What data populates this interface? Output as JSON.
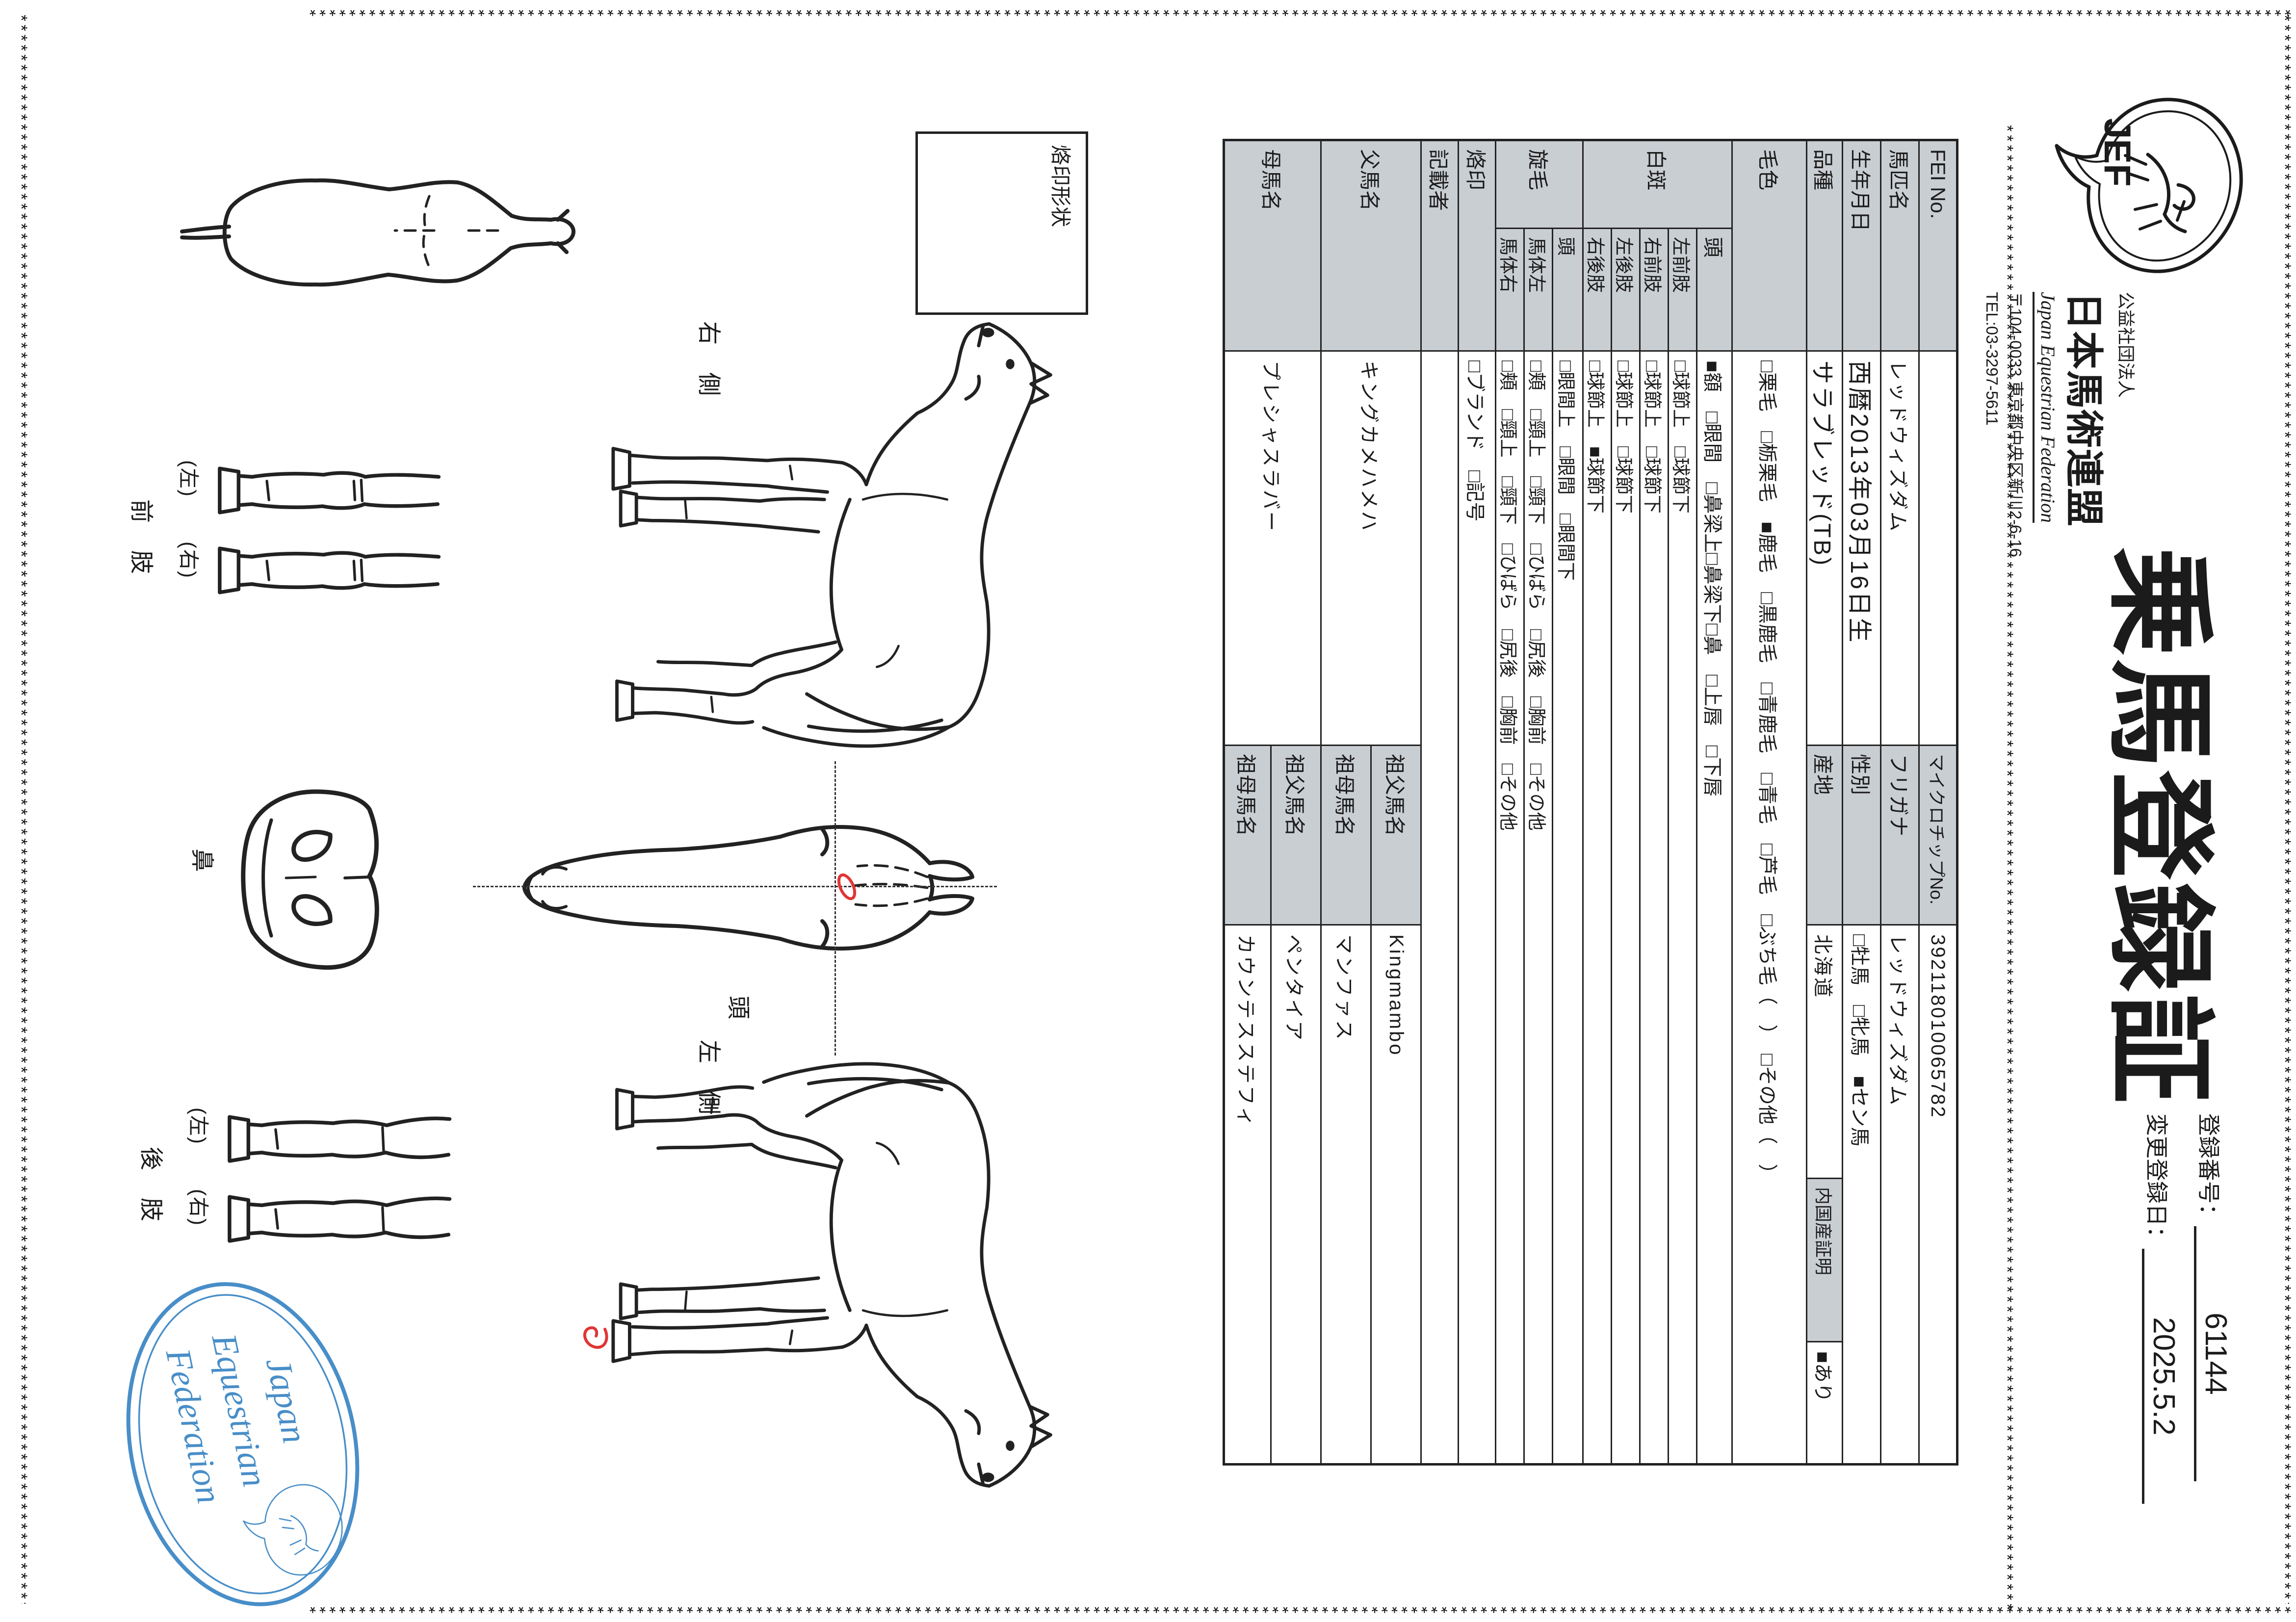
{
  "deco": {
    "line": "********************************************************************************************************************************************************************************************************"
  },
  "header": {
    "org_small": "公益社団法人",
    "org_name": "日本馬術連盟",
    "org_en": "Japan Equestrian Federation",
    "address": "〒104-0033 東京都中央区新川2-6-16",
    "tel": "TEL:03-3297-5611",
    "title": "乗馬登録証",
    "logo_text": "JEF"
  },
  "registration": {
    "no_label": "登録番号：",
    "no": "61144",
    "date_label": "変更登録日：",
    "date": "2025.5.2"
  },
  "table": {
    "fei": {
      "label": "FEI No.",
      "value": ""
    },
    "microchip": {
      "label": "マイクロチップNo.",
      "value": "392118010065782"
    },
    "name": {
      "label": "馬匹名",
      "value": "レッドウィズダム"
    },
    "kana": {
      "label": "フリガナ",
      "value": "レッドウィズダム"
    },
    "birth": {
      "label": "生年月日",
      "value": "西暦2013年03月16日生"
    },
    "sex": {
      "label": "性別",
      "value": "□牡馬　□牝馬　■セン馬"
    },
    "breed": {
      "label": "品種",
      "value": "サラブレッド(TB)"
    },
    "origin": {
      "label": "産地",
      "value": "北海道"
    },
    "domestic": {
      "label": "内国産証明",
      "value": "■あり"
    },
    "coat": {
      "label": "毛色",
      "value": "□栗毛　□栃栗毛　■鹿毛　□黒鹿毛　□青鹿毛　□青毛　□芦毛　□ぶち毛（　）　□その他（　）"
    },
    "hakuhan": {
      "label": "白斑",
      "rows": [
        {
          "part": "頭",
          "value": "■額　□眼間　□鼻梁上□鼻梁下□鼻　□上唇　□下唇"
        },
        {
          "part": "左前肢",
          "value": "□球節上　□球節下"
        },
        {
          "part": "右前肢",
          "value": "□球節上　□球節下"
        },
        {
          "part": "左後肢",
          "value": "□球節上　□球節下"
        },
        {
          "part": "右後肢",
          "value": "□球節上　■球節下"
        }
      ]
    },
    "senmou": {
      "label": "旋毛",
      "rows": [
        {
          "part": "頭",
          "value": "□眼間上　□眼間　□眼間下"
        },
        {
          "part": "馬体左",
          "value": "□頬　□頸上　□頸下　□ひばら　□尻後　□胸前　□その他"
        },
        {
          "part": "馬体右",
          "value": "□頬　□頸上　□頸下　□ひばら　□尻後　□胸前　□その他"
        }
      ]
    },
    "rakuin": {
      "label": "烙印",
      "value": "□ブランド　□記号"
    },
    "kisaisha": {
      "label": "記載者",
      "value": ""
    },
    "sire": {
      "label": "父馬名",
      "value": "キングカメハメハ",
      "gsire_label": "祖父馬名",
      "gsire": "Kingmambo",
      "gdam_label": "祖母馬名",
      "gdam": "マンファス"
    },
    "dam": {
      "label": "母馬名",
      "value": "プレシャスラバー",
      "gsire_label": "祖父馬名",
      "gsire": "ペンタイア",
      "gdam_label": "祖母馬名",
      "gdam": "カウンテスステフィ"
    }
  },
  "diagram": {
    "brand_box_label": "烙印形状",
    "right_side": "右側",
    "left_side": "左側",
    "head": "頭",
    "nose": "鼻",
    "front_legs": "前肢",
    "hind_legs": "後肢",
    "left_paren": "(左)",
    "right_paren": "(右)"
  },
  "stamp": {
    "line1": "Japan",
    "line2": "Equestrian",
    "line3": "Federation"
  },
  "colors": {
    "accent_blue": "#2f7fc1",
    "mark_red": "#e03535",
    "header_gray": "#c9ced3"
  }
}
